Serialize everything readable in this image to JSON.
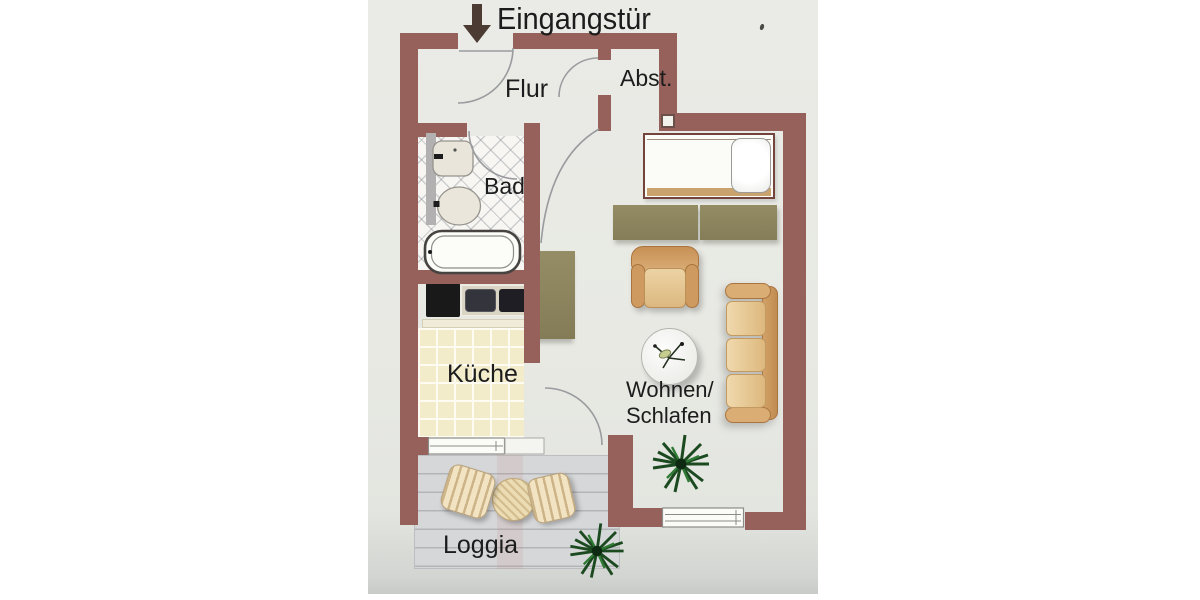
{
  "floorplan": {
    "entrance": {
      "label": "Eingangstür",
      "icon": "down-arrow"
    },
    "rooms": {
      "flur": {
        "label": "Flur"
      },
      "abstellraum": {
        "label": "Abst."
      },
      "bad": {
        "label": "Bad"
      },
      "kueche": {
        "label": "Küche"
      },
      "wohnen_schlafen": {
        "label_line1": "Wohnen/",
        "label_line2": "Schlafen"
      },
      "loggia": {
        "label": "Loggia"
      }
    },
    "icons": {
      "entrance_arrow": "down-arrow",
      "plant": "potted-plant",
      "flower": "flower-sprig",
      "bathtub": "bathtub",
      "toilet": "toilet",
      "sink": "washbasin",
      "stove": "stove",
      "counter": "kitchen-counter-with-sink",
      "bed": "single-bed",
      "wardrobe": "sideboard",
      "armchair": "armchair",
      "sofa": "sofa",
      "table": "round-table",
      "loggia_table": "patio-table",
      "loggia_chairs": "patio-chairs",
      "windows": "window",
      "door_arcs": "door-swing"
    }
  },
  "colors": {
    "page_bg": "#ffffff",
    "paper_bg": "#e8e9e3",
    "wall": "#96615a",
    "wall_dark": "#73443c",
    "text": "#1c1c1c",
    "arrow": "#4b3b33",
    "deck": "#d6d7d9",
    "deck_line": "#b3b4b8",
    "olive": "#8d855e",
    "tan": "#d8ad77",
    "tan_dark": "#bf8b52",
    "tan_light": "#eed9ad",
    "tile": "#f2ecca",
    "plant_dark": "#1c4a20",
    "plant_mid": "#2f7a34",
    "counter_black": "#191919",
    "door_arc": "#9a9b9e"
  }
}
